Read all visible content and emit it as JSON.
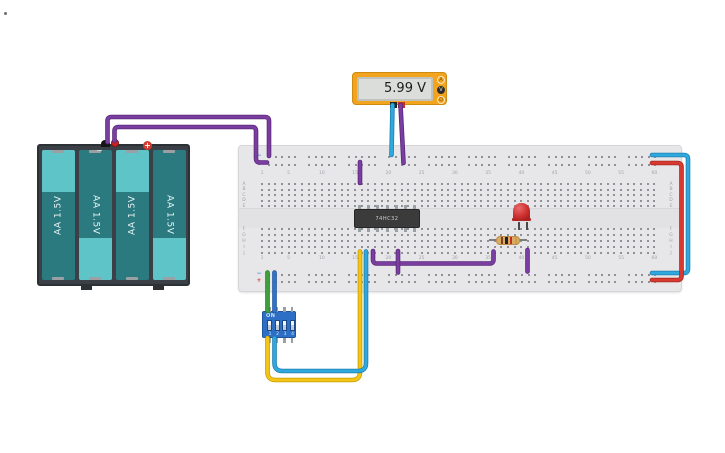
{
  "canvas": {
    "background": "#ffffff"
  },
  "battery_pack": {
    "cells": [
      {
        "label": "AA 1.5V",
        "cap": "top"
      },
      {
        "label": "AA 1.5V",
        "cap": "bottom"
      },
      {
        "label": "AA 1.5V",
        "cap": "top"
      },
      {
        "label": "AA 1.5V",
        "cap": "bottom"
      }
    ],
    "plus_symbol": "+",
    "minus_symbol": "−"
  },
  "multimeter": {
    "reading": "5.99 V",
    "mode_buttons": [
      {
        "name": "amperage",
        "symbol": "A",
        "selected": false
      },
      {
        "name": "voltage",
        "symbol": "V",
        "selected": true
      },
      {
        "name": "resistance",
        "symbol": "Ω",
        "selected": false
      }
    ]
  },
  "breadboard": {
    "column_labels": [
      "1",
      "5",
      "10",
      "15",
      "20",
      "25",
      "30",
      "35",
      "40",
      "45",
      "50",
      "55",
      "60"
    ],
    "row_labels_top": [
      "A",
      "B",
      "C",
      "D",
      "E"
    ],
    "row_labels_bottom": [
      "F",
      "G",
      "H",
      "I",
      "J"
    ],
    "rail_minus": "−",
    "rail_plus": "+"
  },
  "ic": {
    "label": "74HC32"
  },
  "led": {
    "color": "#cd2d2d"
  },
  "resistor": {
    "band_colors": [
      "#7a4520",
      "#222222",
      "#c03020",
      "#caa33c"
    ]
  },
  "dip_switch": {
    "label": "ON",
    "positions": [
      "1",
      "2",
      "3",
      "4"
    ]
  },
  "wires": [
    {
      "name": "wire-battery-negative",
      "color": "#7a3da0",
      "outline": "#59287a",
      "d": "M107.5,142 V121 Q107.5,117 111.5,117 H265 Q269,117 269,121 V156"
    },
    {
      "name": "wire-battery-positive",
      "color": "#7a3da0",
      "outline": "#59287a",
      "d": "M114.5,141 V131 Q114.5,127 118.5,127 H252 Q256,127 256,131 V158.5 Q256,162.5 260,162.5 H267"
    },
    {
      "name": "wire-meter-negative",
      "color": "#2fa9dd",
      "outline": "#1d7fb0",
      "d": "M392.5,105 L391.5,155"
    },
    {
      "name": "wire-meter-positive",
      "color": "#7a3da0",
      "outline": "#59287a",
      "d": "M400.5,105 L403.5,163"
    },
    {
      "name": "wire-power-to-a15",
      "color": "#7a3da0",
      "outline": "#59287a",
      "d": "M360,162 V183"
    },
    {
      "name": "wire-j18-to-j36",
      "color": "#7a3da0",
      "outline": "#59287a",
      "d": "M373,251 V259.5 Q373,263.5 377,263.5 H489.5 Q493.5,263.5 493.5,259.5 V251.5"
    },
    {
      "name": "wire-j22-to-neg-rail",
      "color": "#7a3da0",
      "outline": "#59287a",
      "d": "M398,251 V272.5"
    },
    {
      "name": "wire-j41-to-neg-rail",
      "color": "#7a3da0",
      "outline": "#59287a",
      "d": "M527.5,250 V271.5"
    },
    {
      "name": "wire-rail-bridge-negative",
      "color": "#2fa9dd",
      "outline": "#1d7fb0",
      "d": "M652,155 H684 Q688,155 688,159 V269 Q688,273 684,273 H652"
    },
    {
      "name": "wire-rail-bridge-positive",
      "color": "#d63a30",
      "outline": "#a62520",
      "d": "M652,163 H677.5 Q681.5,163 681.5,167 V276 Q681.5,280 677.5,280 H652"
    },
    {
      "name": "wire-dip1-green",
      "color": "#3da03d",
      "outline": "#2a7a2a",
      "d": "M267.5,311 V272.5"
    },
    {
      "name": "wire-dip2-blue",
      "color": "#2d74c9",
      "outline": "#1d54a0",
      "d": "M274.5,311 V272.5"
    },
    {
      "name": "wire-dip1-yellow",
      "color": "#f3c517",
      "outline": "#c79a00",
      "d": "M267.5,338 V372 Q267.5,380 275.5,380 H352 Q360,380 360,372 V251.5"
    },
    {
      "name": "wire-dip2-cyan",
      "color": "#2fa9dd",
      "outline": "#1d7fb0",
      "d": "M274.5,338 V363 Q274.5,371 282.5,371 H358 Q366,371 366,363 V251.5"
    }
  ]
}
